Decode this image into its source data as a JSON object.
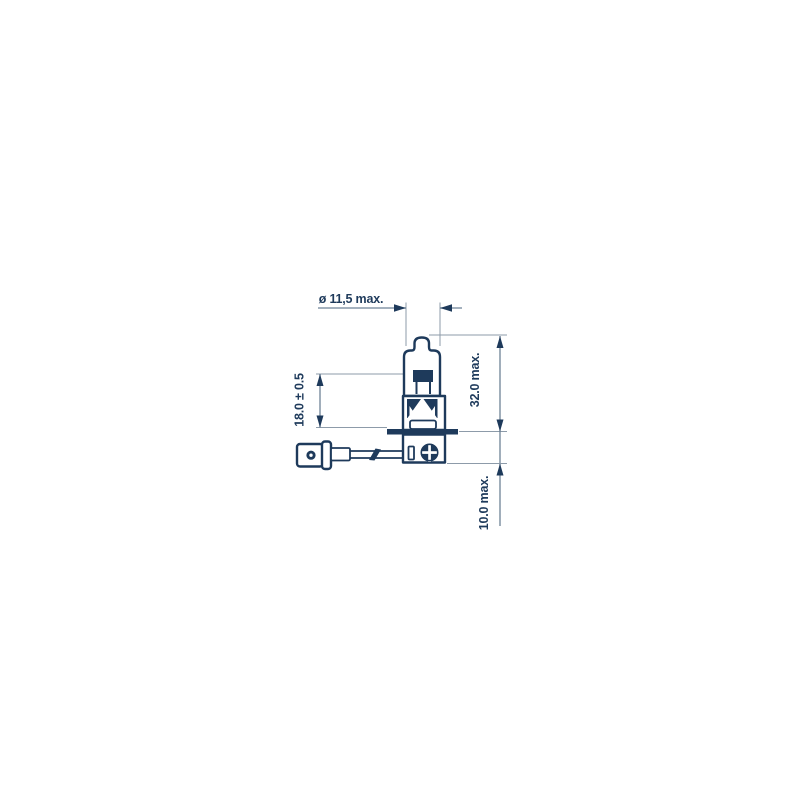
{
  "colors": {
    "ink": "#1e3a5b",
    "dimension_line": "#6e8296",
    "extension_line": "#8d9ba9",
    "background": "#ffffff"
  },
  "diagram": {
    "type": "technical-drawing",
    "subject": "H3 halogen bulb side view with dimension annotations",
    "dimensions": {
      "diameter": {
        "label": "ø 11,5 max."
      },
      "filament_height": {
        "label": "18.0 ± 0.5"
      },
      "overall_length": {
        "label": "32.0 max."
      },
      "base_depth": {
        "label": "10.0 max."
      }
    }
  }
}
